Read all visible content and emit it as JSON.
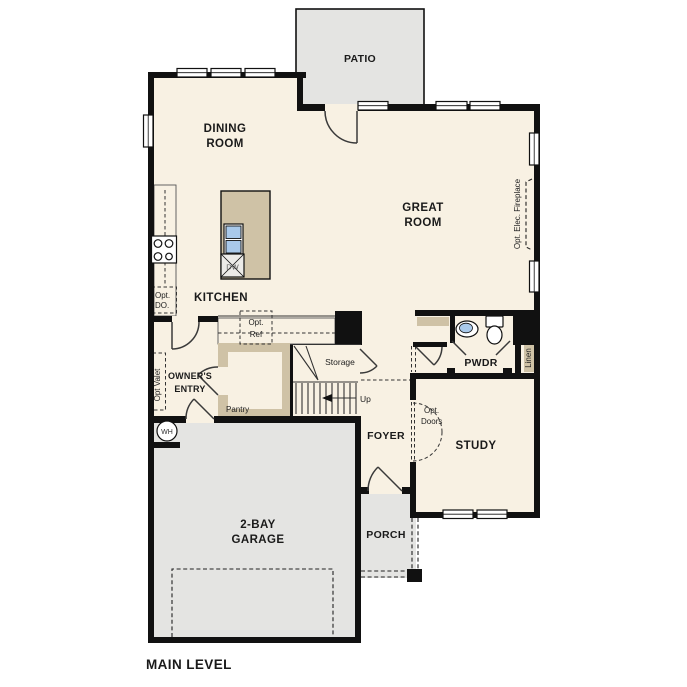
{
  "title": {
    "main_level": "MAIN LEVEL"
  },
  "rooms": {
    "patio": "PATIO",
    "dining_line1": "DINING",
    "dining_line2": "ROOM",
    "great_line1": "GREAT",
    "great_line2": "ROOM",
    "kitchen": "KITCHEN",
    "owners_line1": "OWNER'S",
    "owners_line2": "ENTRY",
    "pantry": "Pantry",
    "storage": "Storage",
    "foyer": "FOYER",
    "pwdr": "PWDR",
    "linen": "Linen",
    "study": "STUDY",
    "garage_line1": "2-BAY",
    "garage_line2": "GARAGE",
    "porch": "PORCH"
  },
  "annotations": {
    "up": "Up",
    "opt_do_line1": "Opt.",
    "opt_do_line2": "DO.",
    "opt_ref_line1": "Opt.",
    "opt_ref_line2": "Ref",
    "opt_valet": "Opt Valet",
    "opt_fireplace": "Opt. Elec. Fireplace",
    "opt_doors_line1": "Opt.",
    "opt_doors_line2": "Doors",
    "dw": "DW",
    "wh": "WH"
  },
  "colors": {
    "wall": "#111111",
    "floor": "#F8F1E3",
    "concrete": "#E4E4E2",
    "counter": "#CFC2A6",
    "sink": "#A9C9EA",
    "opt_box": "#ECEBE8",
    "window": "#FFFFFF"
  }
}
